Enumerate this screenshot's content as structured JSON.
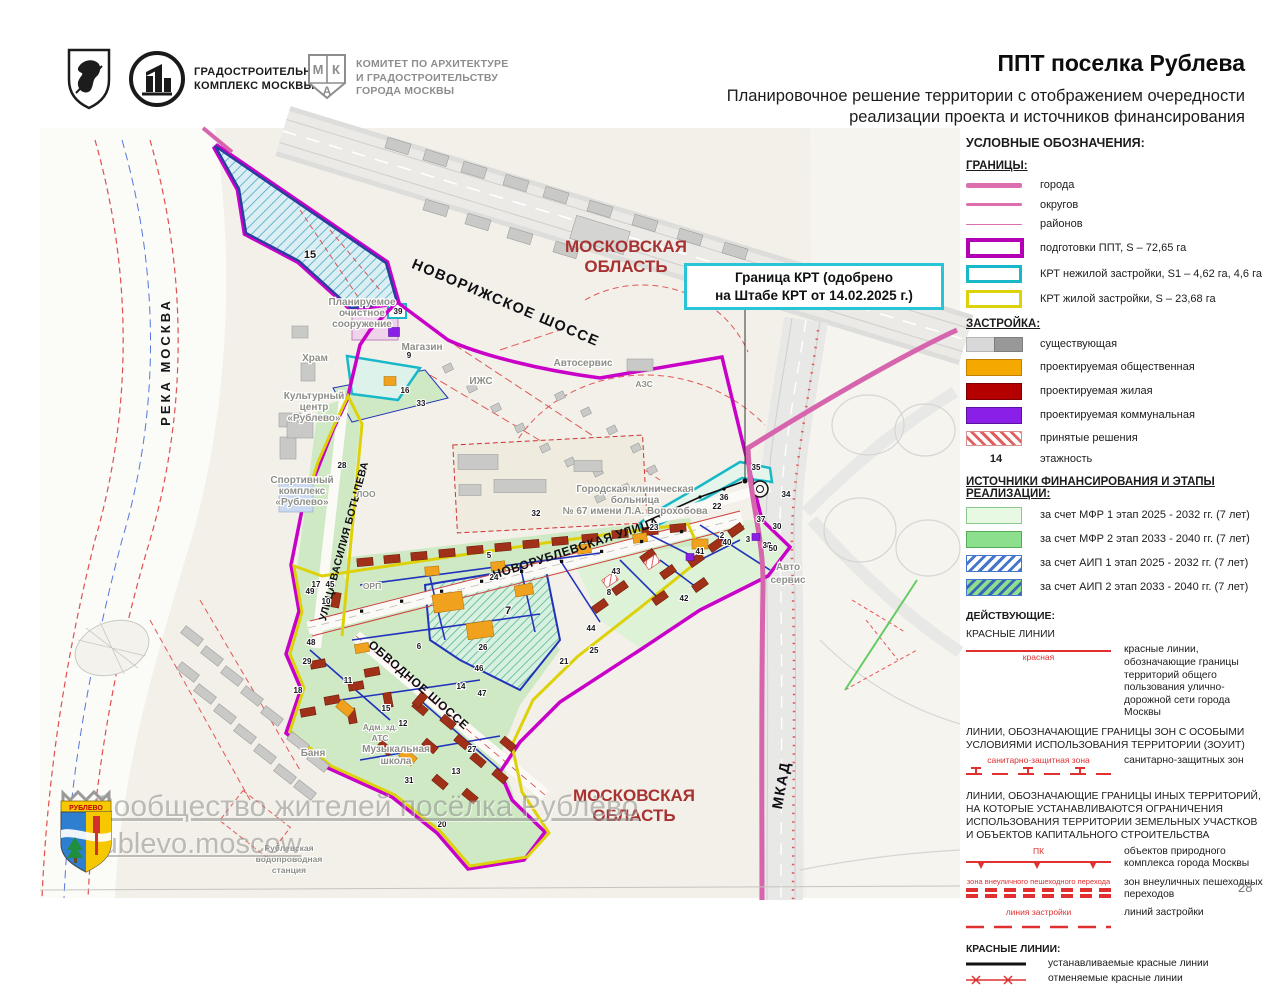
{
  "header": {
    "title": "ППТ поселка Рублева",
    "subtitle1": "Планировочное решение территории с отображением очередности",
    "subtitle2": "реализации проекта и источников финансирования",
    "logo_stroy1": "ГРАДОСТРОИТЕЛЬНЫЙ",
    "logo_stroy2": "КОМПЛЕКС МОСКВЫ",
    "logo_mka1": "КОМИТЕТ ПО АРХИТЕКТУРЕ",
    "logo_mka2": "И ГРАДОСТРОИТЕЛЬСТВУ",
    "logo_mka3": "ГОРОДА МОСКВЫ",
    "mka_m": "М",
    "mka_k": "К",
    "mka_a": "А"
  },
  "callout": {
    "line1": "Граница КРТ (одобрено",
    "line2": "на Штабе КРТ от 14.02.2025 г.)"
  },
  "legend": {
    "title": "УСЛОВНЫЕ ОБОЗНАЧЕНИЯ:",
    "borders": {
      "title": "ГРАНИЦЫ:",
      "items": [
        {
          "label": "города"
        },
        {
          "label": "округов"
        },
        {
          "label": "районов"
        },
        {
          "label": "подготовки ППТ, S – 72,65 га"
        },
        {
          "label": "КРТ нежилой застройки, S1 – 4,62 га, 4,6 га"
        },
        {
          "label": "КРТ жилой застройки, S – 23,68 га"
        }
      ]
    },
    "development": {
      "title": "ЗАСТРОЙКА:",
      "items": [
        {
          "label": "существующая"
        },
        {
          "label": "проектируемая общественная"
        },
        {
          "label": "проектируемая жилая"
        },
        {
          "label": "проектируемая коммунальная"
        },
        {
          "label": "принятые решения"
        },
        {
          "symbol": "14",
          "label": "этажность"
        }
      ]
    },
    "financing": {
      "title1": "ИСТОЧНИКИ ФИНАНСИРОВАНИЯ И ЭТАПЫ",
      "title2": "РЕАЛИЗАЦИИ:",
      "items": [
        {
          "label": "за счет МФР 1 этап 2025 - 2032 гг. (7 лет)"
        },
        {
          "label": "за счет МФР 2 этап 2033 - 2040 гг. (7 лет)"
        },
        {
          "label": "за счет АИП 1 этап 2025 - 2032 гг. (7 лет)"
        },
        {
          "label": "за счет АИП 2 этап 2033 - 2040 гг. (7 лет)"
        }
      ]
    },
    "acting": {
      "title": "ДЕЙСТВУЮЩИЕ:",
      "red_lines_header": "КРАСНЫЕ ЛИНИИ",
      "red_line_label": "красная",
      "red_lines_desc": "красные линии, обозначающие границы территорий общего пользования улично-дорожной сети города Москвы",
      "zouit_header": "ЛИНИИ, ОБОЗНАЧАЮЩИЕ ГРАНИЦЫ ЗОН С ОСОБЫМИ УСЛОВИЯМИ ИСПОЛЬЗОВАНИЯ ТЕРРИТОРИИ (ЗОУИТ)",
      "sanitary_label": "санитарно-защитная зона",
      "sanitary_desc": "санитарно-защитных зон",
      "other_header": "ЛИНИИ, ОБОЗНАЧАЮЩИЕ ГРАНИЦЫ ИНЫХ ТЕРРИТОРИЙ, НА КОТОРЫЕ УСТАНАВЛИВАЮТСЯ ОГРАНИЧЕНИЯ ИСПОЛЬЗОВАНИЯ ТЕРРИТОРИИ ЗЕМЕЛЬНЫХ УЧАСТКОВ И ОБЪЕКТОВ КАПИТАЛЬНОГО СТРОИТЕЛЬСТВА",
      "pk_label": "ПК",
      "pk_desc": "объектов природного комплекса города Москвы",
      "ped_label": "зона внеуличного пешеходного перехода",
      "ped_desc": "зон внеуличных пешеходных переходов",
      "bl_label": "линия застройки",
      "bl_desc": "линий застройки",
      "red_lines2_header": "КРАСНЫЕ ЛИНИИ:",
      "established": "устанавливаемые красные линии",
      "cancelled": "отменяемые красные линии"
    }
  },
  "map": {
    "labels": [
      {
        "text": "РЕКА МОСКВА",
        "x": 170,
        "y": 362,
        "rot": -90,
        "cls": "river"
      },
      {
        "text": "МОСКОВСКАЯ",
        "x": 626,
        "y": 252,
        "cls": "oblast"
      },
      {
        "text": "ОБЛАСТЬ",
        "x": 626,
        "y": 272,
        "cls": "oblast"
      },
      {
        "text": "МОСКОВСКАЯ",
        "x": 634,
        "y": 801,
        "cls": "oblast"
      },
      {
        "text": "ОБЛАСТЬ",
        "x": 634,
        "y": 821,
        "cls": "oblast"
      },
      {
        "text": "НОВОРИЖСКОЕ ШОССЕ",
        "x": 504,
        "y": 307,
        "rot": 23,
        "cls": "road-big"
      },
      {
        "text": "МКАД",
        "x": 786,
        "y": 786,
        "rot": -80,
        "cls": "road-big"
      },
      {
        "text": "УЛИЦА ВАСИЛИЯ БОТЫЛЕВА",
        "x": 347,
        "y": 542,
        "rot": -75,
        "cls": "road-sm"
      },
      {
        "text": "НОВОРУБЛЕВСКАЯ УЛИЦА",
        "x": 577,
        "y": 552,
        "rot": -18,
        "cls": "road-med"
      },
      {
        "text": "ОБВОДНОЕ ШОССЕ",
        "x": 416,
        "y": 688,
        "rot": 41,
        "cls": "road-med"
      },
      {
        "text": "Храм",
        "x": 315,
        "y": 361,
        "cls": "place"
      },
      {
        "text": "Культурный",
        "x": 314,
        "y": 399,
        "cls": "place"
      },
      {
        "text": "центр",
        "x": 314,
        "y": 410,
        "cls": "place"
      },
      {
        "text": "«Рублево»",
        "x": 314,
        "y": 421,
        "cls": "place"
      },
      {
        "text": "Спортивный",
        "x": 302,
        "y": 483,
        "cls": "place"
      },
      {
        "text": "комплекс",
        "x": 302,
        "y": 494,
        "cls": "place"
      },
      {
        "text": "«Рублево»",
        "x": 302,
        "y": 505,
        "cls": "place"
      },
      {
        "text": "Планируемое",
        "x": 362,
        "y": 305,
        "cls": "place"
      },
      {
        "text": "очистное",
        "x": 362,
        "y": 316,
        "cls": "place"
      },
      {
        "text": "сооружение",
        "x": 362,
        "y": 327,
        "cls": "place"
      },
      {
        "text": "Магазин",
        "x": 422,
        "y": 350,
        "cls": "place"
      },
      {
        "text": "ИЖС",
        "x": 481,
        "y": 384,
        "cls": "place"
      },
      {
        "text": "ЛОО",
        "x": 366,
        "y": 497,
        "cls": "place-sm"
      },
      {
        "text": "ОРП",
        "x": 372,
        "y": 589,
        "cls": "place-sm"
      },
      {
        "text": "Городская клиническая",
        "x": 635,
        "y": 492,
        "cls": "place"
      },
      {
        "text": "больница",
        "x": 635,
        "y": 503,
        "cls": "place"
      },
      {
        "text": "№ 67 имени Л.А. Ворохобова",
        "x": 635,
        "y": 514,
        "cls": "place"
      },
      {
        "text": "Автосервис",
        "x": 583,
        "y": 366,
        "cls": "place"
      },
      {
        "text": "АЗС",
        "x": 644,
        "y": 387,
        "cls": "place-sm"
      },
      {
        "text": "Авто",
        "x": 788,
        "y": 570,
        "cls": "place"
      },
      {
        "text": "сервис",
        "x": 788,
        "y": 583,
        "cls": "place"
      },
      {
        "text": "Баня",
        "x": 313,
        "y": 756,
        "cls": "place"
      },
      {
        "text": "Адм. зд.",
        "x": 380,
        "y": 730,
        "cls": "place-sm"
      },
      {
        "text": "АТС",
        "x": 380,
        "y": 741,
        "cls": "place-sm"
      },
      {
        "text": "Музыкальная",
        "x": 396,
        "y": 752,
        "cls": "place"
      },
      {
        "text": "школа",
        "x": 396,
        "y": 764,
        "cls": "place"
      },
      {
        "text": "Рублевская",
        "x": 289,
        "y": 851,
        "cls": "place-sm"
      },
      {
        "text": "водопроводная",
        "x": 289,
        "y": 862,
        "cls": "place-sm"
      },
      {
        "text": "станция",
        "x": 289,
        "y": 873,
        "cls": "place-sm"
      }
    ],
    "numbers": [
      {
        "t": "15",
        "x": 310,
        "y": 258,
        "b": 1
      },
      {
        "t": "39",
        "x": 398,
        "y": 314
      },
      {
        "t": "9",
        "x": 409,
        "y": 358
      },
      {
        "t": "16",
        "x": 405,
        "y": 393
      },
      {
        "t": "33",
        "x": 421,
        "y": 406
      },
      {
        "t": "28",
        "x": 342,
        "y": 468
      },
      {
        "t": "32",
        "x": 536,
        "y": 516
      },
      {
        "t": "35",
        "x": 756,
        "y": 470
      },
      {
        "t": "36",
        "x": 724,
        "y": 500
      },
      {
        "t": "22",
        "x": 717,
        "y": 509
      },
      {
        "t": "34",
        "x": 786,
        "y": 497
      },
      {
        "t": "23",
        "x": 654,
        "y": 530
      },
      {
        "t": "37",
        "x": 761,
        "y": 522
      },
      {
        "t": "30",
        "x": 777,
        "y": 529
      },
      {
        "t": "2",
        "x": 722,
        "y": 538
      },
      {
        "t": "40",
        "x": 727,
        "y": 545
      },
      {
        "t": "3",
        "x": 748,
        "y": 542
      },
      {
        "t": "38",
        "x": 767,
        "y": 548
      },
      {
        "t": "50",
        "x": 773,
        "y": 551
      },
      {
        "t": "41",
        "x": 700,
        "y": 554
      },
      {
        "t": "5",
        "x": 489,
        "y": 558
      },
      {
        "t": "24",
        "x": 494,
        "y": 580
      },
      {
        "t": "43",
        "x": 616,
        "y": 574
      },
      {
        "t": "8",
        "x": 609,
        "y": 595
      },
      {
        "t": "7",
        "x": 508,
        "y": 614,
        "b": 1
      },
      {
        "t": "44",
        "x": 591,
        "y": 631
      },
      {
        "t": "42",
        "x": 684,
        "y": 601
      },
      {
        "t": "26",
        "x": 483,
        "y": 650
      },
      {
        "t": "6",
        "x": 419,
        "y": 649
      },
      {
        "t": "25",
        "x": 594,
        "y": 653
      },
      {
        "t": "21",
        "x": 564,
        "y": 664
      },
      {
        "t": "46",
        "x": 479,
        "y": 671
      },
      {
        "t": "14",
        "x": 461,
        "y": 689
      },
      {
        "t": "47",
        "x": 482,
        "y": 696
      },
      {
        "t": "48",
        "x": 311,
        "y": 645
      },
      {
        "t": "29",
        "x": 307,
        "y": 664
      },
      {
        "t": "18",
        "x": 298,
        "y": 693
      },
      {
        "t": "11",
        "x": 348,
        "y": 683
      },
      {
        "t": "15",
        "x": 386,
        "y": 711
      },
      {
        "t": "12",
        "x": 403,
        "y": 726
      },
      {
        "t": "27",
        "x": 472,
        "y": 752
      },
      {
        "t": "13",
        "x": 456,
        "y": 774
      },
      {
        "t": "31",
        "x": 409,
        "y": 783
      },
      {
        "t": "20",
        "x": 442,
        "y": 827
      },
      {
        "t": "17",
        "x": 316,
        "y": 587
      },
      {
        "t": "45",
        "x": 330,
        "y": 587
      },
      {
        "t": "49",
        "x": 310,
        "y": 594
      },
      {
        "t": "10",
        "x": 326,
        "y": 604
      }
    ]
  },
  "watermark": {
    "line1": "Сообщество жителей посёлка Рублёво",
    "line2": "rublevo.moscow"
  },
  "crest": {
    "text": "РУБЛЕВО"
  },
  "page_number": "28",
  "colors": {
    "ppt_boundary": "#c800c8",
    "city_border": "#d765ad",
    "krt_nonres": "#18b8c8",
    "krt_res": "#ddd20a",
    "public": "#f5a800",
    "residential": "#b50000",
    "communal": "#8a20e8",
    "mfr1": "#e7f8e3",
    "mfr2": "#8cdf8c",
    "red_line": "#e03030",
    "oblast_text": "#a83232"
  }
}
